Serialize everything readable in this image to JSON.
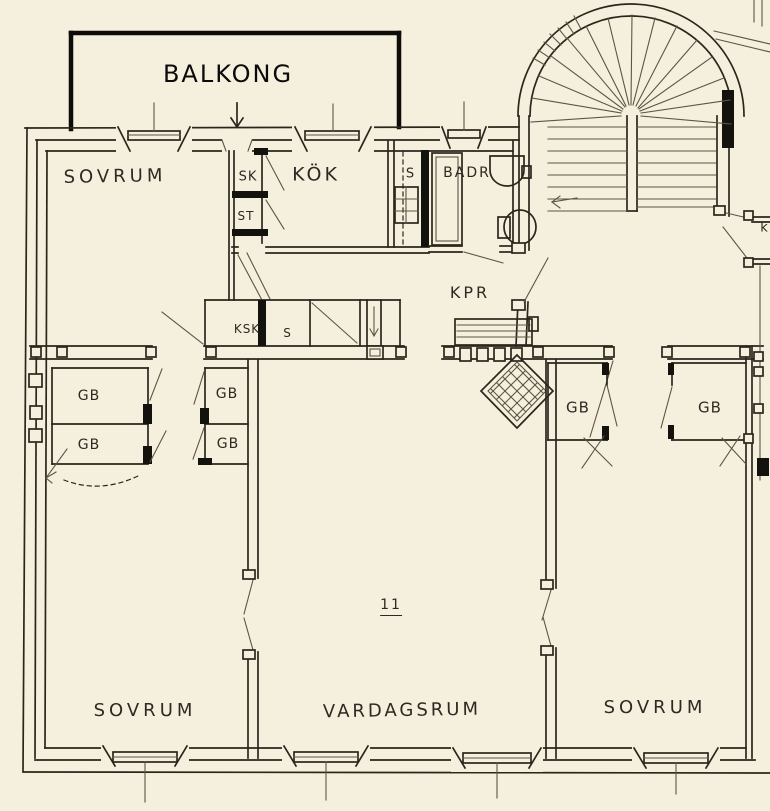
{
  "colors": {
    "paper": "#f5f0dd",
    "ink": "#2b261d",
    "black": "#14120d"
  },
  "plan": {
    "balcony_label": "BALKONG",
    "apartment_number": "11",
    "rooms": {
      "bedroom_top_left": "SOVRUM",
      "kitchen": "KÖK",
      "bathroom": "BADR",
      "hall": "KPR",
      "living_room": "VARDAGSRUM",
      "bedroom_bottom_left": "SOVRUM",
      "bedroom_bottom_right": "SOVRUM"
    },
    "closets": {
      "sk": "SK",
      "st": "ST",
      "pantry": "S",
      "ksk": "KSK",
      "hall_s": "S",
      "wardrobes": [
        "GB",
        "GB",
        "GB",
        "GB",
        "GB",
        "GB"
      ]
    },
    "edge_label": "k"
  }
}
